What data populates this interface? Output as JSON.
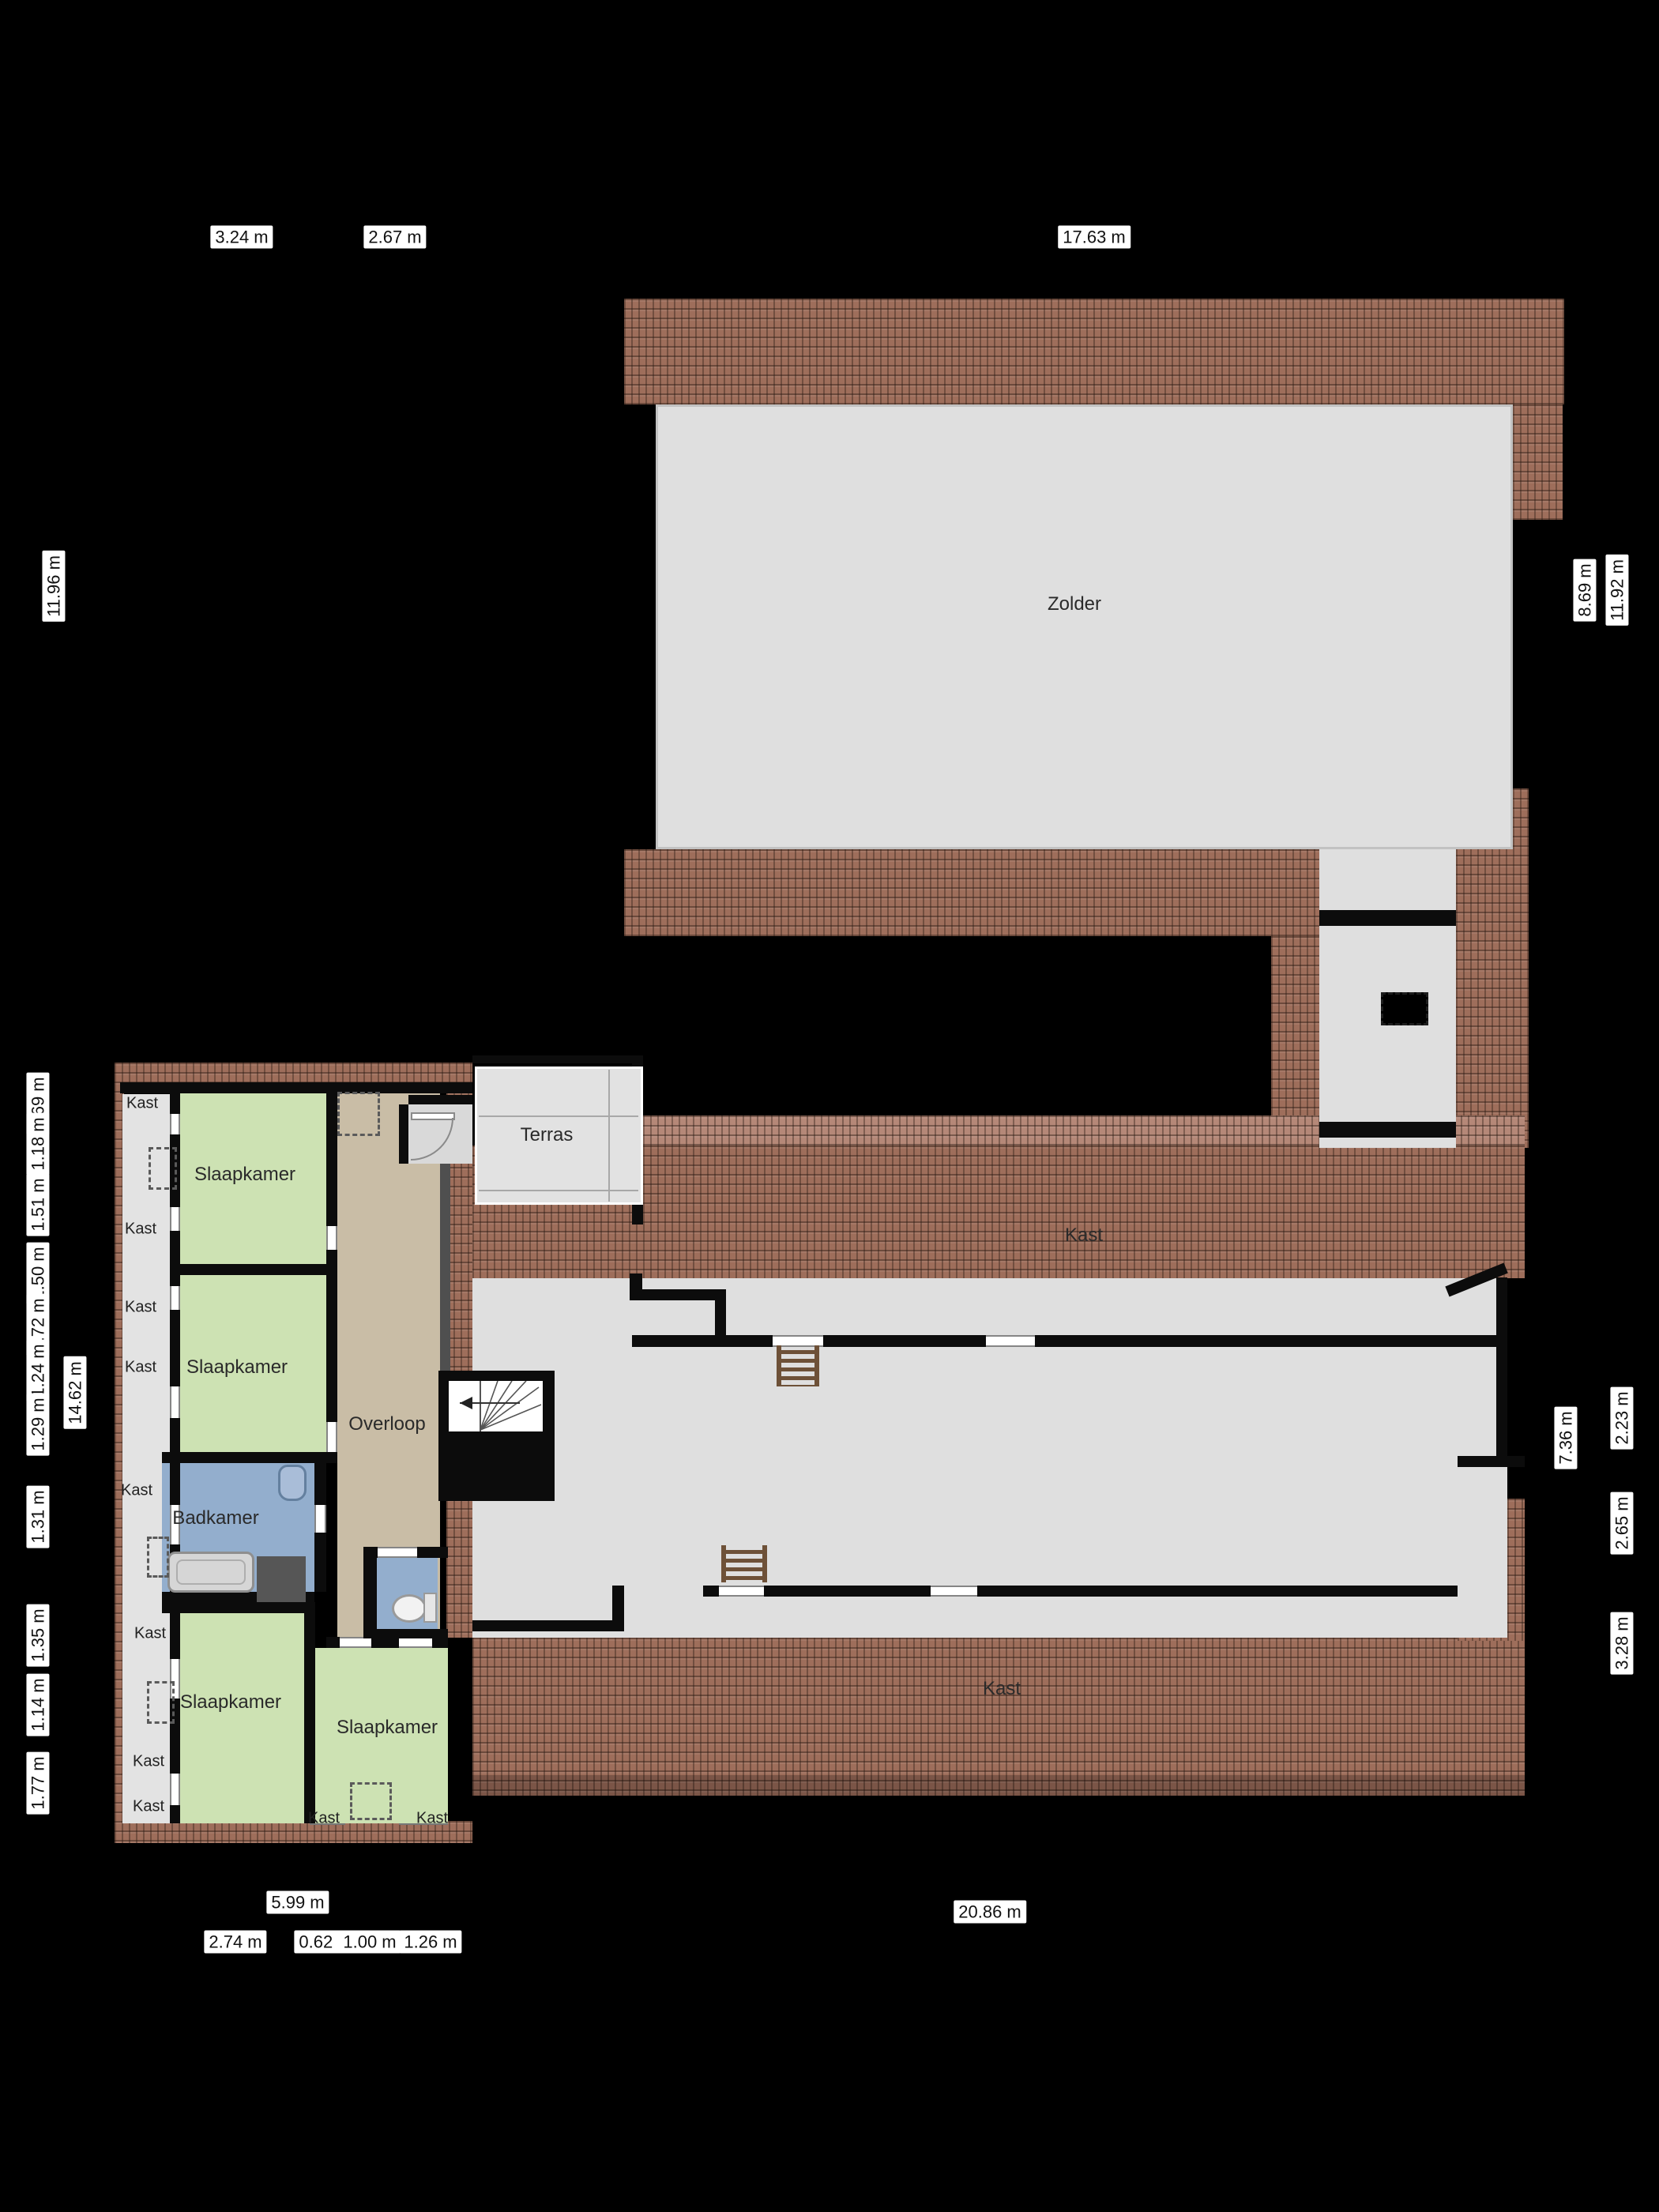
{
  "rooms": {
    "zolder": "Zolder",
    "terras": "Terras",
    "overloop": "Overloop",
    "badkamer": "Badkamer",
    "slaapkamer": "Slaapkamer",
    "kast": "Kast"
  },
  "dimensions": {
    "top": [
      "3.24 m",
      "2.67 m",
      "17.63 m"
    ],
    "left_overall": [
      "11.96 m",
      "14.62 m"
    ],
    "left_segments": [
      "0.69 m",
      "1.18 m",
      "1.51 m",
      "1.50 m",
      "0.72 m",
      "1.24 m",
      "1.29 m",
      "1.31 m",
      "1.35 m",
      "1.14 m",
      "1.77 m"
    ],
    "right": [
      "8.69 m",
      "11.92 m",
      "7.36 m",
      "2.23 m",
      "2.65 m",
      "3.28 m"
    ],
    "bottom_overall": [
      "5.99 m",
      "20.86 m"
    ],
    "bottom_segments": [
      "2.74 m",
      "0.62 m",
      "1.00 m",
      "1.26 m"
    ]
  },
  "colors": {
    "background": "#000000",
    "roof_tile": "#9e6e5b",
    "floor_gray": "#dfdfdf",
    "bedroom_green": "#cde2b3",
    "hall_tan": "#c9bda6",
    "bathroom_blue": "#93aecd",
    "wall_black": "#0c0c0c"
  }
}
